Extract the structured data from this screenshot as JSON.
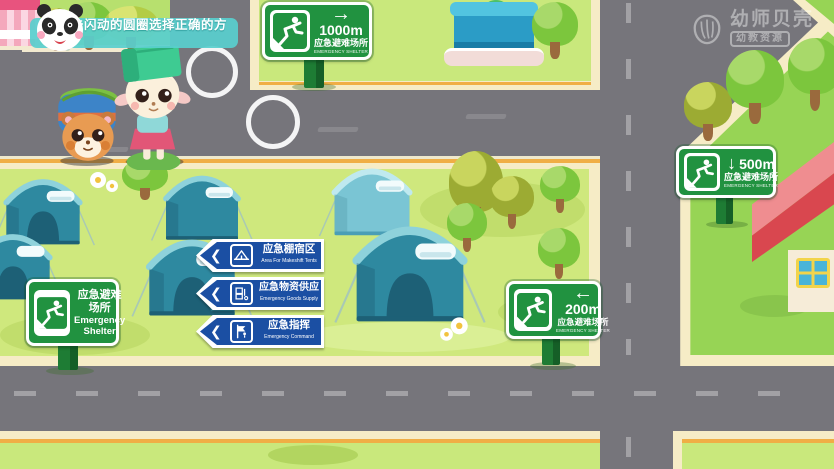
{
  "scene": {
    "watermark": {
      "brand": "幼师贝壳",
      "badge": "幼教资源"
    },
    "bubble": {
      "text": "点击闪动的圆圈选择正确的方向"
    }
  },
  "signs": {
    "d1000": {
      "arrow": "→",
      "distance": "1000m",
      "cn": "应急避难场所",
      "en": "EMERGENCY SHELTER"
    },
    "d500": {
      "arrow": "↓",
      "distance": "500m",
      "cn": "应急避难场所",
      "en": "EMERGENCY SHELTER"
    },
    "d200": {
      "arrow": "←",
      "distance": "200m",
      "cn": "应急避难场所",
      "en": "EMERGENCY SHELTER"
    },
    "shelter": {
      "cn1": "应急避难",
      "cn2": "场所",
      "en1": "Emergency",
      "en2": "Shelter"
    }
  },
  "blue_chevron": "❮",
  "blue_signs": [
    {
      "cn": "应急棚宿区",
      "en": "Area For Makeshift Tents"
    },
    {
      "cn": "应急物资供应",
      "en": "Emergency Goods Supply"
    },
    {
      "cn": "应急指挥",
      "en": "Emergency Command"
    }
  ],
  "colors": {
    "road": "#76757b",
    "field_green": "#cfe87d",
    "side_green": "#97d455",
    "sign_green": "#219240",
    "sign_blue": "#1b4fa3",
    "bubble_teal": "#59cfcd",
    "border_cream": "#f6ecc6",
    "accent_orange": "#f0ae45"
  }
}
